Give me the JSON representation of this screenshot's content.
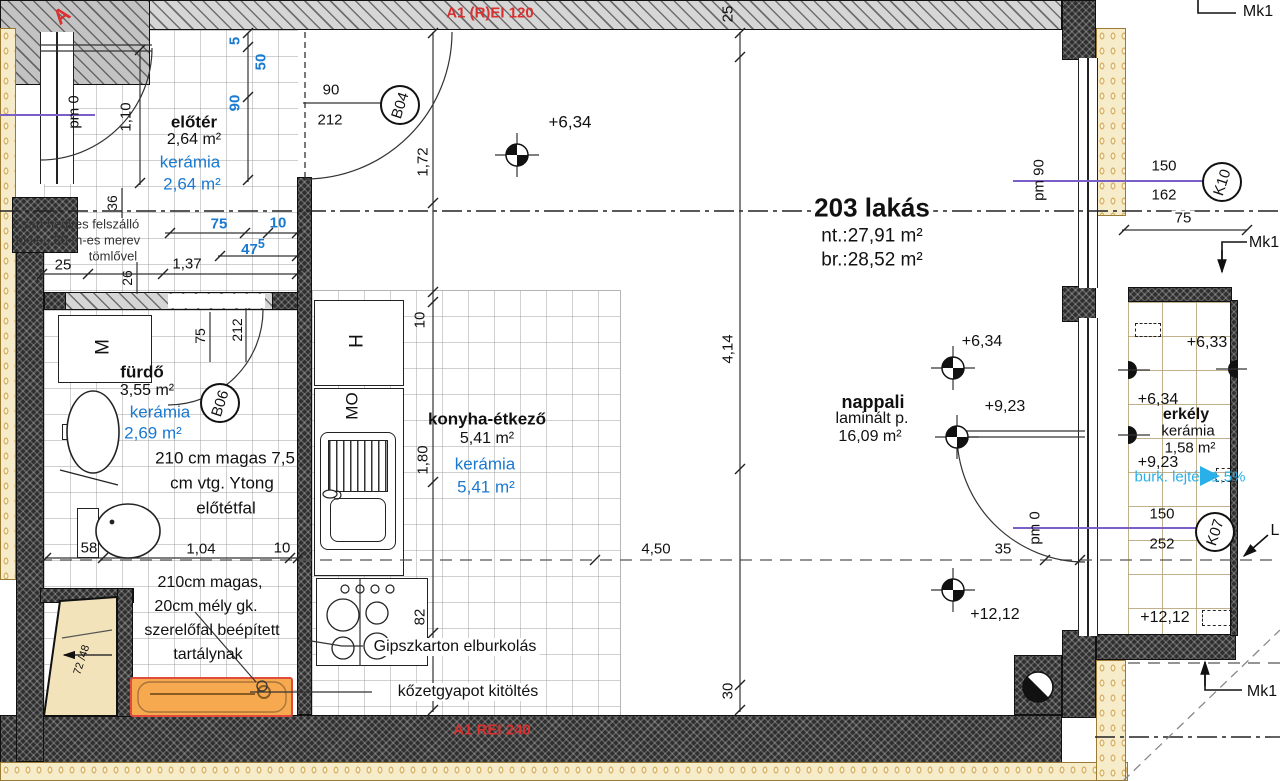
{
  "fire_ratings": {
    "top": "A1 (R)EI 120",
    "bottom": "A1 REI 240",
    "section_marker": "A"
  },
  "apartment": {
    "number_name": "203 lakás",
    "net_area": "nt.:27,91 m²",
    "gross_area": "br.:28,52 m²"
  },
  "rooms": {
    "eloter": {
      "name": "előtér",
      "area": "2,64 m²",
      "finish": "kerámia",
      "finish_area": "2,64 m²"
    },
    "furdo": {
      "name": "fürdő",
      "area": "3,55 m²",
      "finish": "kerámia",
      "finish_area": "2,69 m²"
    },
    "konyha": {
      "name": "konyha-étkező",
      "area": "5,41 m²",
      "finish": "kerámia",
      "finish_area": "5,41 m²"
    },
    "nappali": {
      "name": "nappali",
      "floor": "laminált p.",
      "area": "16,09 m²"
    },
    "erkely": {
      "name": "erkély",
      "finish": "kerámia",
      "area": "1,58 m²",
      "slope_note": "burk. lejtés 1,5%"
    }
  },
  "elevations": {
    "top_634": "+6,34",
    "nap_634": "+6,34",
    "nap_923": "+9,23",
    "nap_1212": "+12,12",
    "erk_633": "+6,33",
    "erk_634": "+6,34",
    "erk_923": "+9,23",
    "erk_1212": "+12,12"
  },
  "levels": {
    "pm0_eloter": "pm 0",
    "pm90_right": "pm 90",
    "pm0_nappali": "pm 0"
  },
  "tags": {
    "b04": "B04",
    "b06": "B06",
    "k10": "K10",
    "k07": "K07",
    "mk1_top": "Mk1",
    "mk1_mid": "Mk1",
    "mk1_bottom": "Mk1",
    "l_ref": "L"
  },
  "notes": {
    "hose_l1": "Csap nedves felszálló",
    "hose_l2": "ékkel, 30 m-es merev",
    "hose_l3": "tömlővel",
    "ytong_l1": "210 cm magas 7,5",
    "ytong_l2": "cm vtg. Ytong",
    "ytong_l3": "előtétfal",
    "szer_l1": "210cm magas,",
    "szer_l2": "20cm mély gk.",
    "szer_l3": "szerelőfal beépített",
    "szer_l4": "tartálynak",
    "gipszkarton": "Gipszkarton elburkolás",
    "kozetgyapot": "kőzetgyapot kitöltés"
  },
  "fixtures": {
    "washing_machine": "M",
    "fridge": "H",
    "dishwasher": "MO"
  },
  "dims": {
    "d5": "5",
    "d50": "50",
    "d90v": "90",
    "d75_blue": "75",
    "d10_blue": "10",
    "d47": "47",
    "d47_sup": "5",
    "d110": "1,10",
    "d36": "36",
    "d26": "26",
    "d25_left": "25",
    "d137": "1,37",
    "b04_w": "90",
    "b04_h": "212",
    "d172": "1,72",
    "d25_top": "25",
    "d414": "4,14",
    "d450": "4,50",
    "d30": "30",
    "d35": "35",
    "b06_w": "75",
    "b06_h": "212",
    "d58": "58",
    "d104": "1,04",
    "d10_f": "10",
    "d10_k": "10",
    "d180": "1,80",
    "d82": "82",
    "k10_w": "150",
    "k10_h": "162",
    "d75_k10": "75",
    "k07_w": "150",
    "k07_h": "252",
    "d7248": "72 /48"
  },
  "colors": {
    "finish_blue": "#1a79d0",
    "slope_cyan": "#29b0e8",
    "fire_red": "#d93030",
    "level_purple": "#7a5fc6",
    "tub_orange": "#f6a94f"
  }
}
